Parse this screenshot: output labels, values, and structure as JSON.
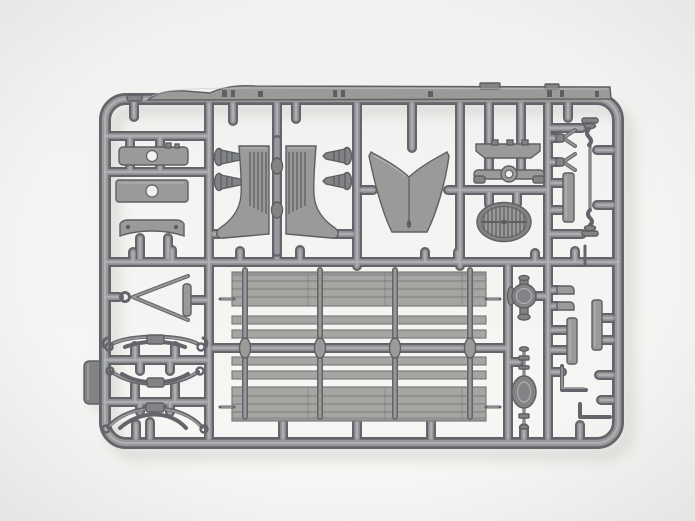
{
  "scene": {
    "type": "product-photograph",
    "subject": "Gray plastic model-kit sprue with molded truck parts on a white studio background",
    "text_visible": "none",
    "sprue_color": "medium gray styrene",
    "background_color": "off-white"
  },
  "palette": {
    "bg-top": "#f2f1ef",
    "bg-bottom": "#f8f7f5",
    "vignette": "#e2e1df",
    "shadow": "#c9c8c5",
    "plastic-dark": "#63656a",
    "plastic-mid": "#97999b",
    "plastic-light": "#c9cbcd",
    "part-fill": "#9a9b99",
    "part-dark": "#818385",
    "part-line": "#5d5f62",
    "panel-fill": "#a5a5a1",
    "panel-line": "#7c7d79"
  },
  "sprue": {
    "frame": "rounded rectangle with internal runners and gate stubs",
    "release_tab": "left edge",
    "parts": [
      {
        "name": "chassis-side-rail",
        "count": 1
      },
      {
        "name": "front-fender",
        "count": 2
      },
      {
        "name": "hood-cowl",
        "count": 1
      },
      {
        "name": "radiator-shell",
        "count": 1
      },
      {
        "name": "frame-crossmember",
        "count": 2
      },
      {
        "name": "mounting-bracket-bar",
        "count": 3
      },
      {
        "name": "horn-pin",
        "count": 4
      },
      {
        "name": "tow-bar",
        "count": 1
      },
      {
        "name": "leaf-spring",
        "count": 3
      },
      {
        "name": "cargo-bed-side-panel",
        "count": 2
      },
      {
        "name": "cargo-bed-plank",
        "count": 4
      },
      {
        "name": "stake-post",
        "count": 8
      },
      {
        "name": "differential-housing",
        "count": 1
      },
      {
        "name": "rear-axle",
        "count": 1
      },
      {
        "name": "drag-link-rod",
        "count": 1
      },
      {
        "name": "clevis-fork",
        "count": 2
      },
      {
        "name": "flat-bar",
        "count": 2
      },
      {
        "name": "l-shaped-rod",
        "count": 2
      }
    ]
  }
}
